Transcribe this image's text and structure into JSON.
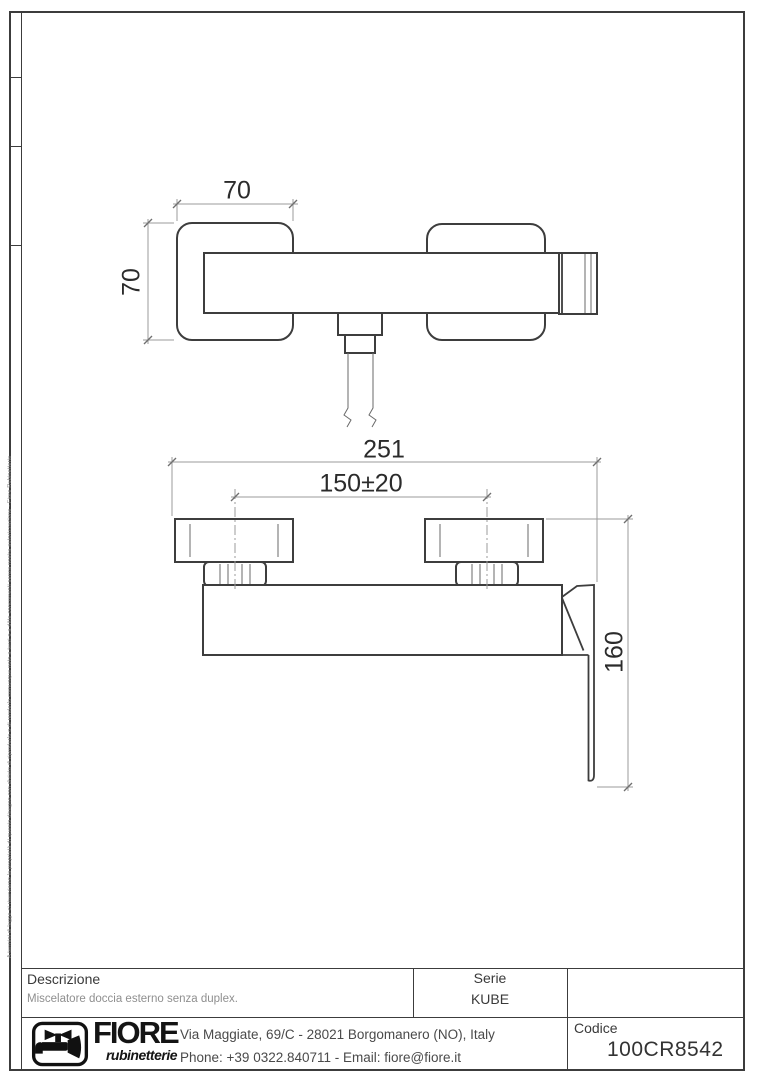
{
  "sheet": {
    "side_note": "A termini di legge ci riserviamo la proprietà di questo disegno con divieto di riprodurlo o di renderlo comunque noto a terzi o a ditte concorrenti senza nostra autorizzazione - Fiore Rubinetterie"
  },
  "drawing": {
    "dim_plate_width": "70",
    "dim_plate_height": "70",
    "dim_overall_width": "251",
    "dim_centers": "150±20",
    "dim_height": "160"
  },
  "title_block": {
    "description_label": "Descrizione",
    "description_value": "Miscelatore doccia esterno senza duplex.",
    "series_label": "Serie",
    "series_value": "KUBE",
    "code_label": "Codice",
    "code_value": "100CR8542",
    "company_name": "FIORE",
    "company_tagline": "rubinetterie",
    "address": "Via Maggiate, 69/C - 28021 Borgomanero (NO), Italy",
    "contact": "Phone: +39 0322.840711 - Email: fiore@fiore.it",
    "logo_color": "#111111"
  }
}
